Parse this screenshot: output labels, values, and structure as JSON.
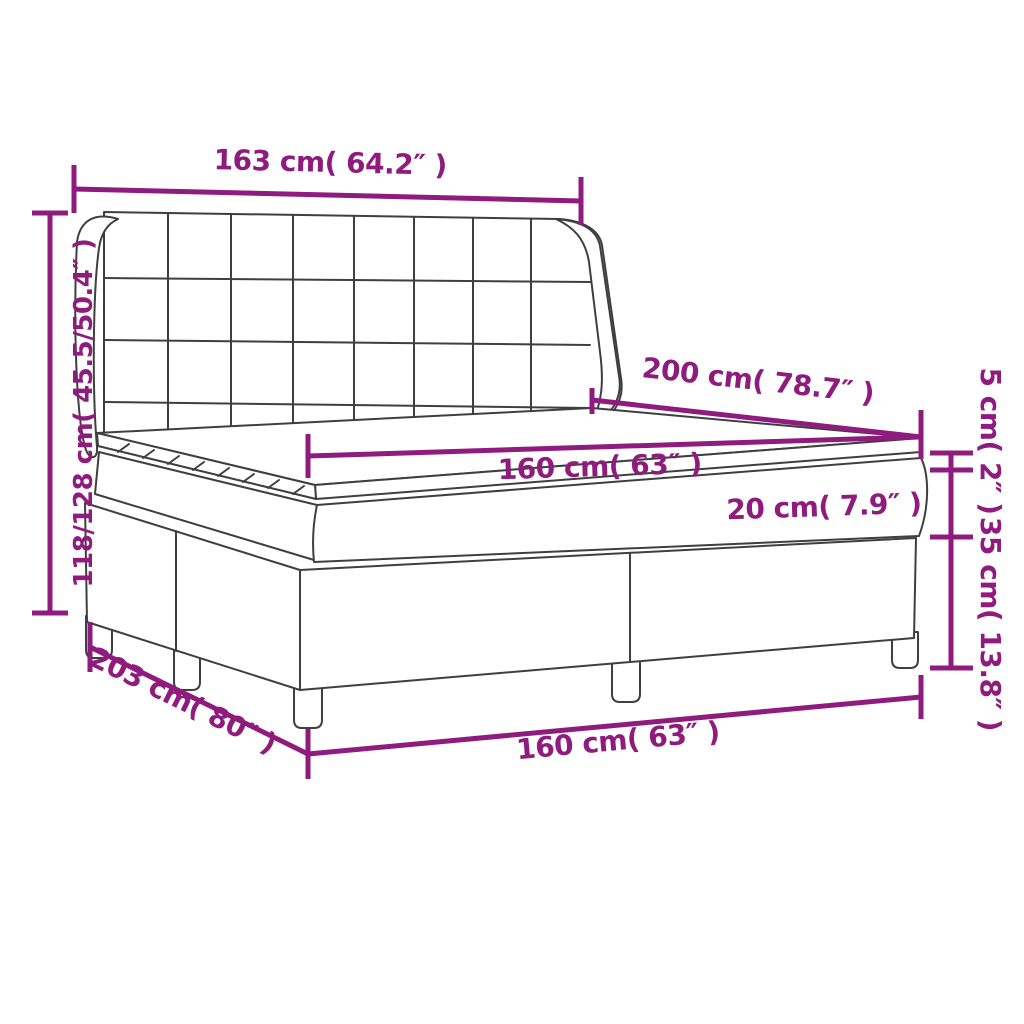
{
  "page": {
    "background": "#ffffff",
    "description": "Dimension diagram of a box spring bed with tufted wing headboard, two-piece base on legs, mattress and mattress topper"
  },
  "style": {
    "dimension_color": "#8e1b7d",
    "outline_color": "#3f3f3f"
  },
  "dimensions": {
    "headboard_width": {
      "label": "163 cm( 64.2″ )",
      "cm": 163,
      "inch": 64.2
    },
    "overall_height": {
      "label": "118/128 cm( 45.5/50.4″ )",
      "cm_min": 118,
      "cm_max": 128,
      "inch_min": 45.5,
      "inch_max": 50.4
    },
    "bed_length": {
      "label": "200 cm( 78.7″ )",
      "cm": 200,
      "inch": 78.7
    },
    "mattress_width": {
      "label": "160 cm( 63″ )",
      "cm": 160,
      "inch": 63
    },
    "mattress_height": {
      "label": "20 cm( 7.9″ )",
      "cm": 20,
      "inch": 7.9
    },
    "topper_height": {
      "label": "5 cm( 2″ )",
      "cm": 5,
      "inch": 2
    },
    "base_height": {
      "label": "35 cm( 13.8″ )",
      "cm": 35,
      "inch": 13.8
    },
    "overall_length": {
      "label": "203 cm( 80″ )",
      "cm": 203,
      "inch": 80
    },
    "base_width": {
      "label": "160 cm( 63″ )",
      "cm": 160,
      "inch": 63
    }
  }
}
